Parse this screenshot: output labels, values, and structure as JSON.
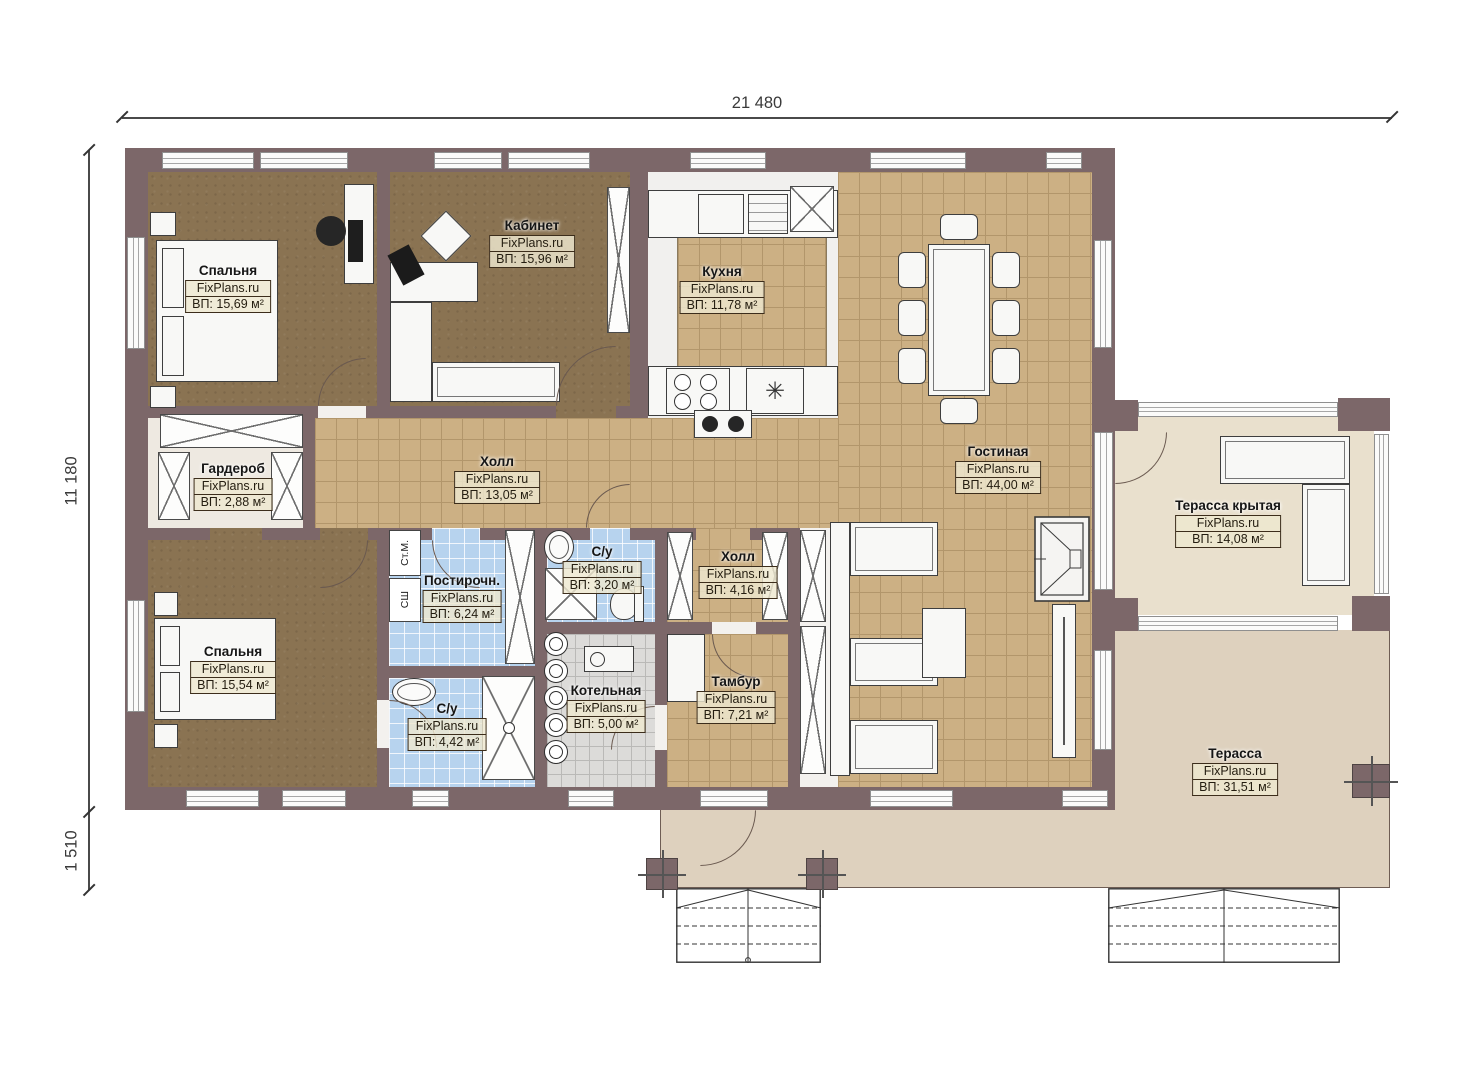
{
  "watermark": "FixPlans.ru",
  "dimensions": {
    "width_total": "21 480",
    "height_main": "11 180",
    "height_porch": "1 510"
  },
  "rooms": [
    {
      "name": "Спальня",
      "area": "ВП: 15,69 м²"
    },
    {
      "name": "Кабинет",
      "area": "ВП: 15,96 м²"
    },
    {
      "name": "Кухня",
      "area": "ВП: 11,78 м²"
    },
    {
      "name": "Гостиная",
      "area": "ВП: 44,00 м²"
    },
    {
      "name": "Холл",
      "area": "ВП: 13,05 м²"
    },
    {
      "name": "Гардероб",
      "area": "ВП: 2,88 м²"
    },
    {
      "name": "Спальня",
      "area": "ВП: 15,54 м²"
    },
    {
      "name": "Постирочн.",
      "area": "ВП: 6,24 м²"
    },
    {
      "name": "С/у",
      "area": "ВП: 3,20 м²"
    },
    {
      "name": "Холл",
      "area": "ВП: 4,16 м²"
    },
    {
      "name": "С/у",
      "area": "ВП: 4,42 м²"
    },
    {
      "name": "Котельная",
      "area": "ВП: 5,00 м²"
    },
    {
      "name": "Тамбур",
      "area": "ВП: 7,21 м²"
    },
    {
      "name": "Терасса крытая",
      "area": "ВП: 14,08 м²"
    },
    {
      "name": "Терасса",
      "area": "ВП: 31,51 м²"
    }
  ],
  "appliances": {
    "washer": "Ст.М.",
    "dryer": "СШ"
  },
  "symbols": {
    "freezer": "✳"
  },
  "colors": {
    "wall": "#7c6769",
    "wood_floor": "#8a7352",
    "tile_floor": "#ccb084",
    "wet_tile": "#b7d3ee",
    "boiler_tile": "#dcdbd9",
    "terrace": "#ded1be",
    "covered_terrace": "#e9e0cd",
    "label_box_bg": "#eee8d0",
    "label_border": "#3c2d1b"
  }
}
